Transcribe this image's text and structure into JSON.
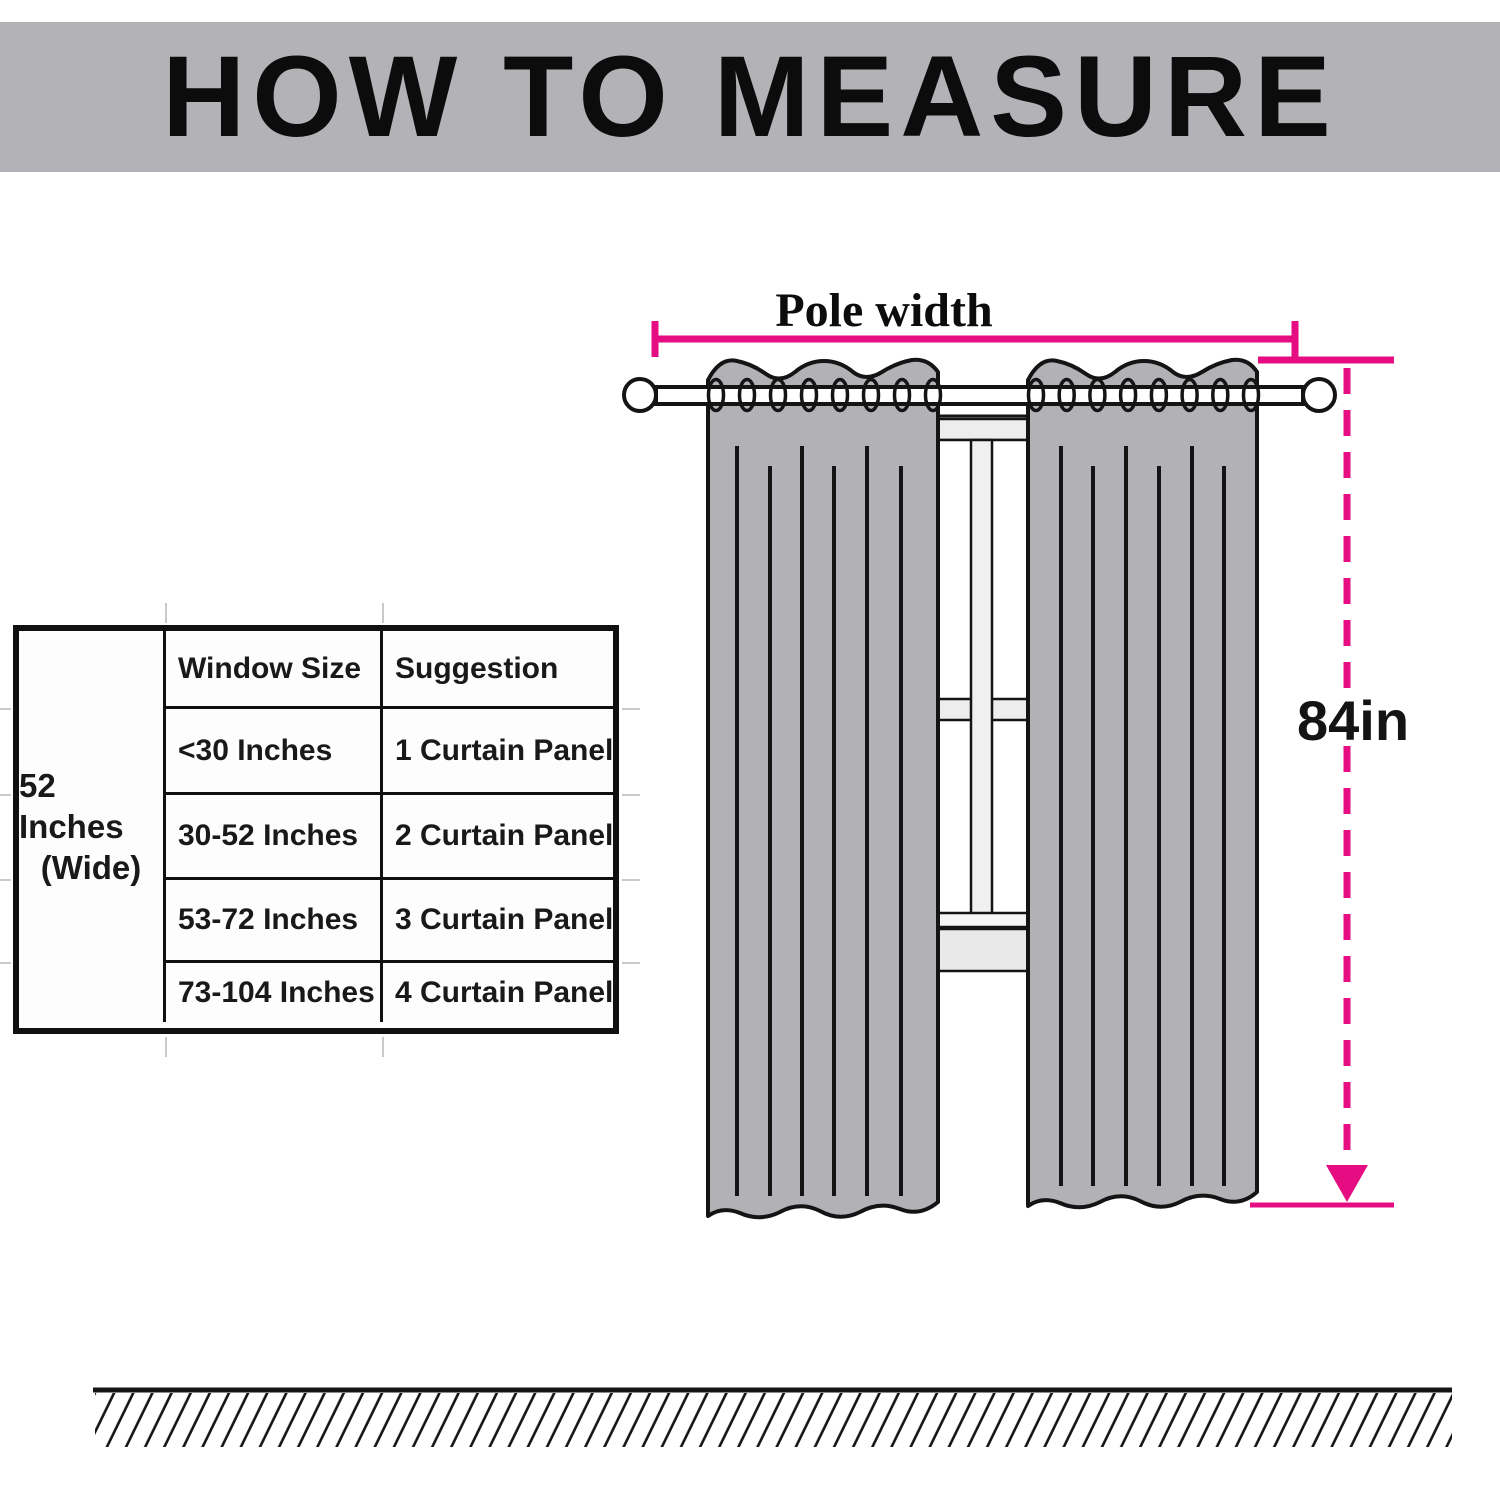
{
  "title": "HOW TO MEASURE",
  "size_table": {
    "width_label_line1": "52 Inches",
    "width_label_line2": "(Wide)",
    "headers": {
      "window_size": "Window Size",
      "suggestion": "Suggestion"
    },
    "rows": [
      {
        "window_size": "<30 Inches",
        "suggestion": "1 Curtain Panel"
      },
      {
        "window_size": "30-52 Inches",
        "suggestion": "2 Curtain Panel"
      },
      {
        "window_size": "53-72 Inches",
        "suggestion": "3 Curtain Panel"
      },
      {
        "window_size": "73-104 Inches",
        "suggestion": "4 Curtain Panel"
      }
    ]
  },
  "diagram": {
    "pole_width_label": "Pole width",
    "curtain_length_label": "84in",
    "colors": {
      "measurement_accent": "#e60c82",
      "curtain_gray": "#b2b2b6",
      "banner_gray": "#b3b3b7",
      "window_frame_gray": "#ededed",
      "line_black": "#141414"
    }
  }
}
